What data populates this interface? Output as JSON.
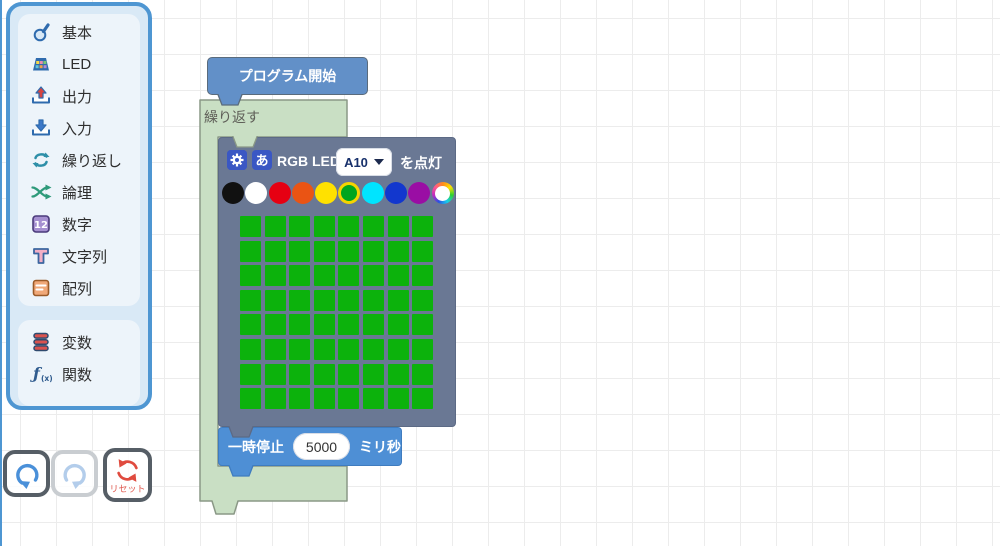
{
  "colors": {
    "toolbox_border": "#4E96D2",
    "toolbox_bg": "#D9E9F6",
    "toolbox_group_bg": "#EDF4FA",
    "start_block": "#6290C8",
    "repeat_block": "#C9DFC4",
    "rgb_block": "#6A7894",
    "pause_block": "#4E8FD5",
    "led_on": "#0CB20C",
    "grid_line": "#ECECEC",
    "selected_ring": "#F5D400"
  },
  "toolbox": {
    "groups": [
      {
        "items": [
          {
            "label": "基本",
            "icon": "hand-icon"
          },
          {
            "label": "LED",
            "icon": "led-matrix-icon"
          },
          {
            "label": "出力",
            "icon": "output-tray-icon"
          },
          {
            "label": "入力",
            "icon": "input-tray-icon"
          },
          {
            "label": "繰り返し",
            "icon": "loop-arrows-icon"
          },
          {
            "label": "論理",
            "icon": "shuffle-arrows-icon"
          },
          {
            "label": "数字",
            "icon": "number-icon"
          },
          {
            "label": "文字列",
            "icon": "text-icon"
          },
          {
            "label": "配列",
            "icon": "array-icon"
          }
        ]
      },
      {
        "items": [
          {
            "label": "変数",
            "icon": "variable-icon"
          },
          {
            "label": "関数",
            "icon": "function-icon"
          }
        ]
      }
    ]
  },
  "blocks": {
    "start": {
      "label": "プログラム開始"
    },
    "repeat": {
      "label": "繰り返す"
    },
    "rgb_led": {
      "label": "RGB LED",
      "port": "A10",
      "suffix": "を点灯",
      "kana_icon": "あ",
      "palette": [
        "#111111",
        "#FFFFFF",
        "#E60012",
        "#EA5414",
        "#FFE100",
        "#00A51E",
        "#00E4FF",
        "#1237CE",
        "#9A0EA4",
        "rainbow"
      ],
      "selected_index": 5,
      "grid": {
        "rows": 8,
        "cols": 8
      }
    },
    "pause": {
      "label": "一時停止",
      "value": "5000",
      "unit": "ミリ秒"
    }
  },
  "controls": {
    "reset": {
      "label": "リセット"
    }
  }
}
